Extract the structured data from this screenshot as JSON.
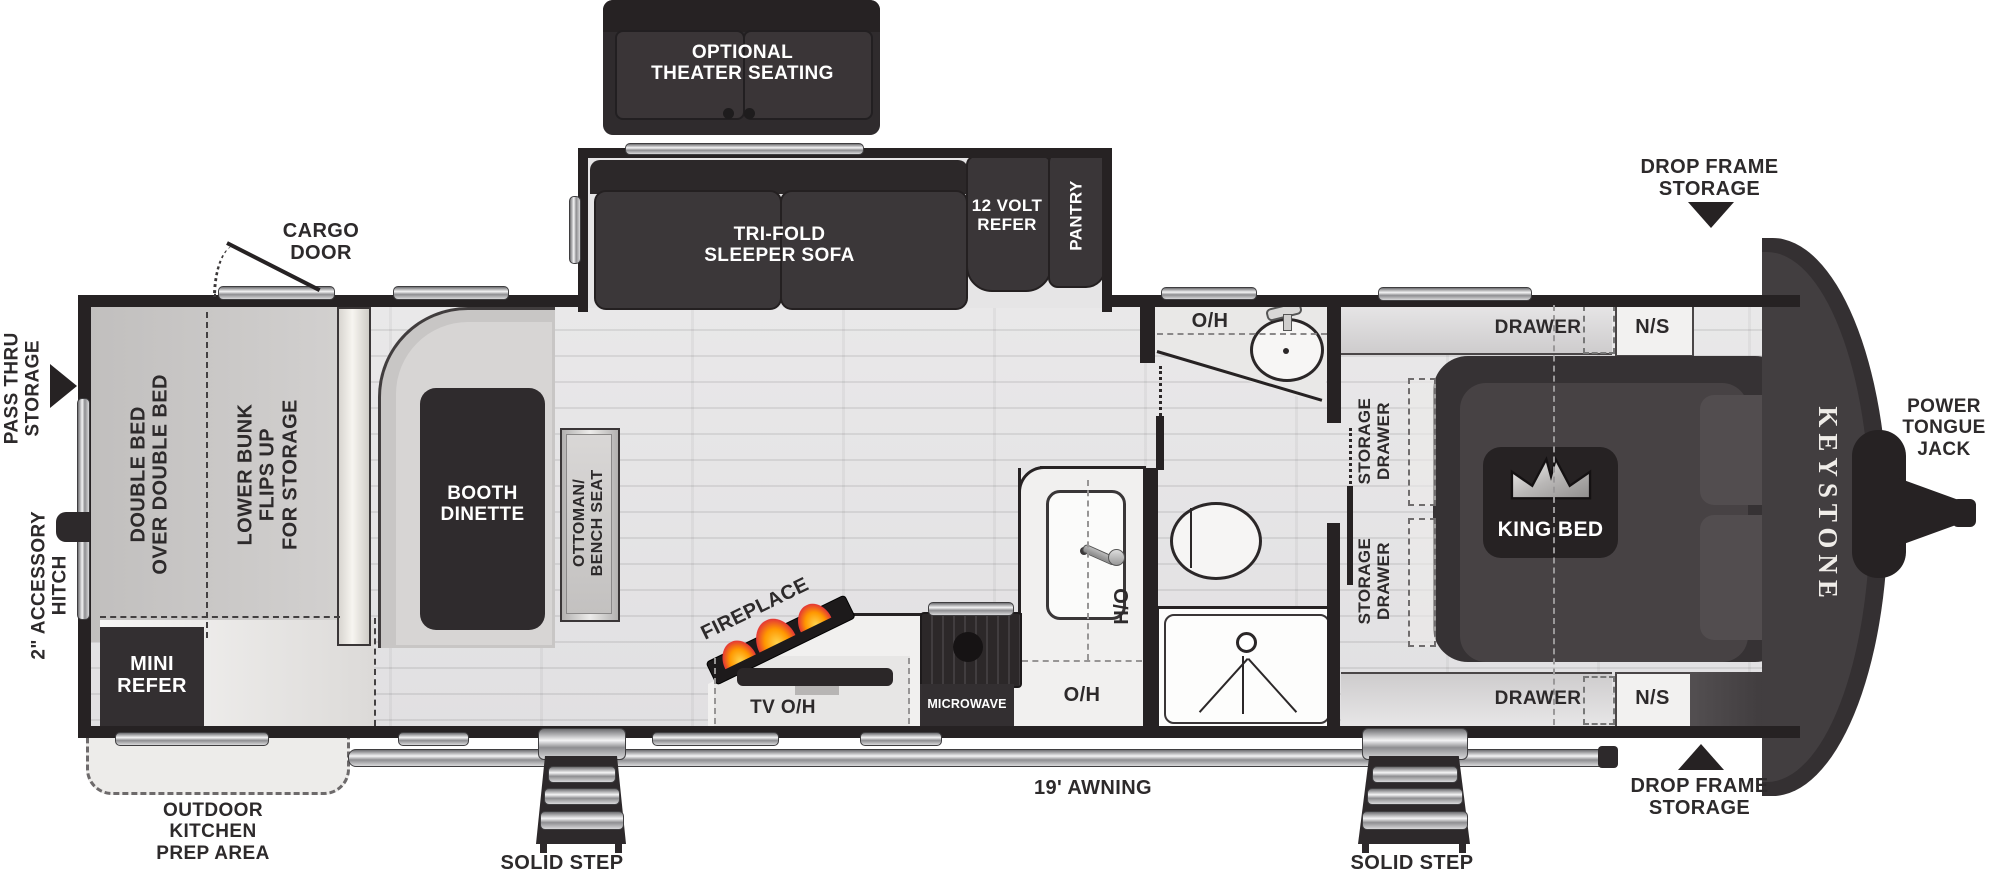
{
  "colors": {
    "wall": "#262223",
    "furniture_dark": "#3a3638",
    "floor": "#e7e6e8",
    "bench_gray": "#cac8c7",
    "flame_orange": "#ff9800",
    "flame_red": "#e53935"
  },
  "exterior": {
    "front": {
      "brand": "KEYSTONE",
      "power_tongue_jack": "POWER\nTONGUE\nJACK",
      "drop_frame_storage_top": "DROP FRAME\nSTORAGE",
      "drop_frame_storage_bottom": "DROP FRAME\nSTORAGE"
    },
    "rear": {
      "pass_thru_storage": "PASS THRU\nSTORAGE",
      "accessory_hitch": "2\" ACCESSORY\nHITCH",
      "cargo_door": "CARGO\nDOOR"
    },
    "door_side": {
      "awning": "19' AWNING",
      "solid_step_left": "SOLID STEP",
      "solid_step_right": "SOLID STEP",
      "outdoor_kitchen": "OUTDOOR\nKITCHEN\nPREP AREA"
    }
  },
  "slide_out": {
    "theater_seating": "OPTIONAL\nTHEATER SEATING",
    "sofa": "TRI-FOLD\nSLEEPER SOFA",
    "refer": "12 VOLT\nREFER",
    "pantry": "PANTRY"
  },
  "bunk_room": {
    "double_bed": "DOUBLE BED\nOVER DOUBLE BED",
    "lower_bunk": "LOWER BUNK\nFLIPS UP\nFOR STORAGE",
    "mini_refer": "MINI\nREFER"
  },
  "living": {
    "dinette": "BOOTH\nDINETTE",
    "ottoman": "OTTOMAN/\nBENCH SEAT",
    "fireplace": "FIREPLACE"
  },
  "kitchen": {
    "tv_oh": "TV O/H",
    "microwave": "MICROWAVE",
    "oh": "O/H",
    "ho": "H/O"
  },
  "bathroom": {
    "oh": "O/H"
  },
  "bedroom": {
    "king_bed": "KING BED",
    "drawer_top": "DRAWER",
    "ns_top": "N/S",
    "drawer_bottom": "DRAWER",
    "ns_bottom": "N/S",
    "storage_drawer_1": "STORAGE\nDRAWER",
    "storage_drawer_2": "STORAGE\nDRAWER"
  }
}
